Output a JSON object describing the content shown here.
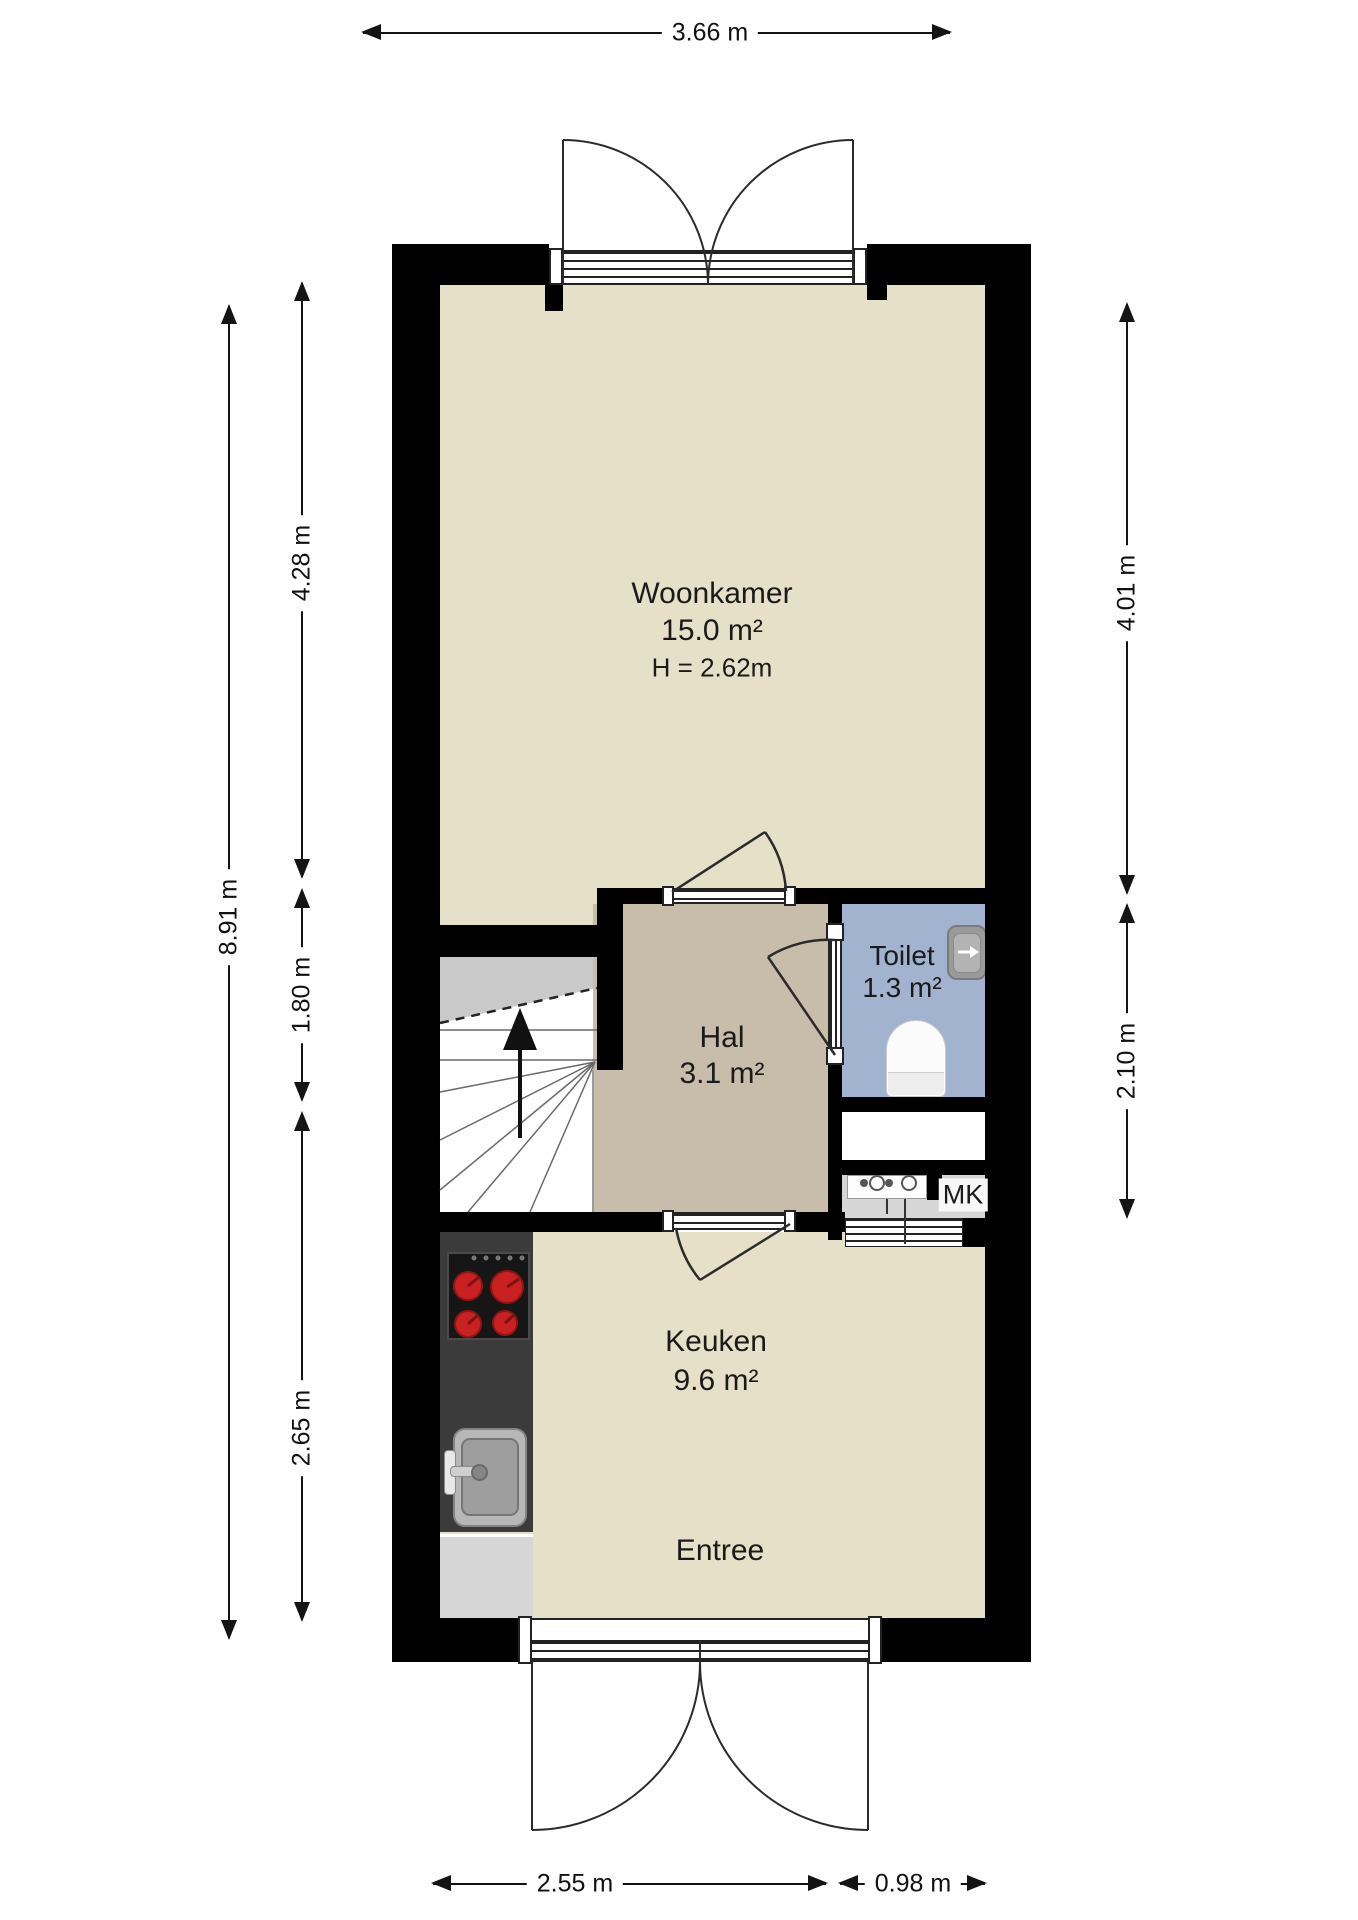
{
  "plan": {
    "rooms": {
      "woonkamer": {
        "name": "Woonkamer",
        "area": "15.0 m²",
        "height": "H = 2.62m"
      },
      "hal": {
        "name": "Hal",
        "area": "3.1 m²"
      },
      "toilet": {
        "name": "Toilet",
        "area": "1.3 m²"
      },
      "keuken": {
        "name": "Keuken",
        "area": "9.6 m²"
      },
      "entree": {
        "name": "Entree"
      },
      "meterkast": {
        "label": "MK"
      }
    },
    "dimensions": {
      "top_width": "3.66 m",
      "left_total": "8.91 m",
      "left_upper": "4.28 m",
      "left_middle": "1.80 m",
      "left_lower": "2.65 m",
      "right_upper": "4.01 m",
      "right_lower": "2.10 m",
      "bottom_left": "2.55 m",
      "bottom_right": "0.98 m"
    },
    "colors": {
      "wall": "#000000",
      "floor_main": "#e6e0c8",
      "floor_hall": "#c8bcab",
      "floor_toilet": "#a2b3cf",
      "floor_mk": "#d6d6d6",
      "stairs_upper_flight": "#c9c9c9",
      "kitchen_counter": "#3b3b3b",
      "burner_red": "#c92121"
    }
  }
}
